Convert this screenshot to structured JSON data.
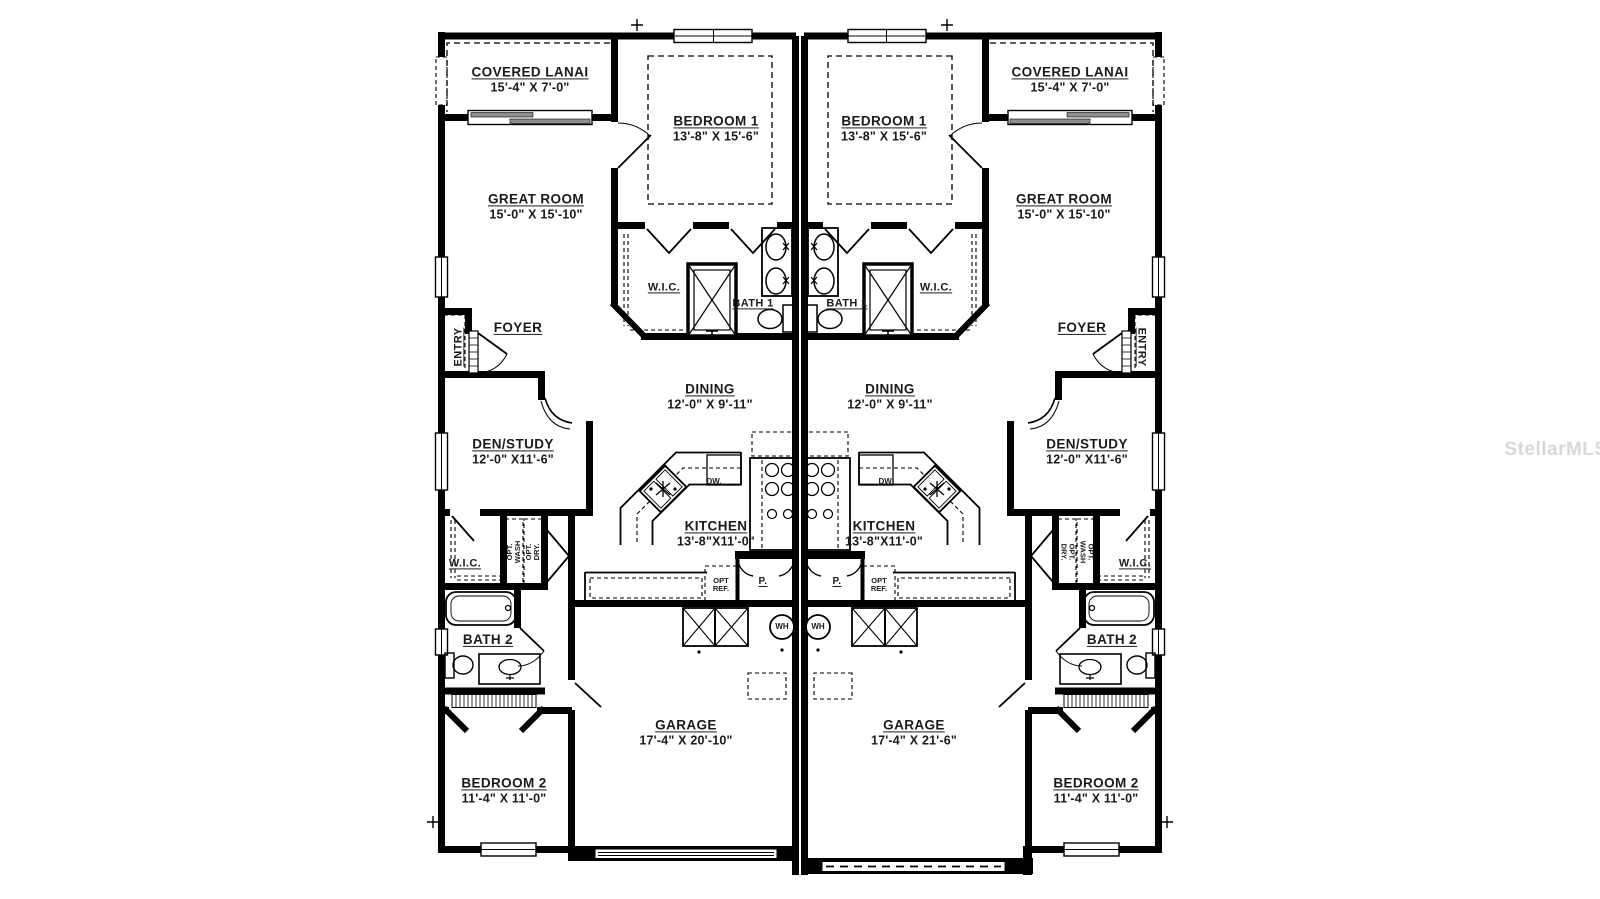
{
  "watermark": "StellarMLS",
  "colors": {
    "walls": "#000000",
    "background": "#ffffff",
    "watermark_text": "#d8d8d8",
    "sliding_door_panel": "#8f8f8f"
  },
  "rooms": {
    "covered_lanai": {
      "label": "COVERED LANAI",
      "dims": "15'-4\" X 7'-0\""
    },
    "great_room": {
      "label": "GREAT ROOM",
      "dims": "15'-0\" X 15'-10\""
    },
    "bedroom_1": {
      "label": "BEDROOM 1",
      "dims": "13'-8\" X 15'-6\""
    },
    "wic_primary": {
      "label": "W.I.C."
    },
    "bath_1": {
      "label": "BATH 1"
    },
    "dining": {
      "label": "DINING",
      "dims": "12'-0\" X 9'-11\""
    },
    "kitchen": {
      "label": "KITCHEN",
      "dims": "13'-8\"X11'-0\""
    },
    "entry": {
      "label": "ENTRY"
    },
    "foyer": {
      "label": "FOYER"
    },
    "den_study": {
      "label": "DEN/STUDY",
      "dims": "12'-0\" X11'-6\""
    },
    "wic_secondary": {
      "label": "W.I.C."
    },
    "bath_2": {
      "label": "BATH 2"
    },
    "bedroom_2": {
      "label": "BEDROOM 2",
      "dims": "11'-4\" X 11'-0\""
    },
    "garage_left": {
      "label": "GARAGE",
      "dims": "17'-4\" X 20'-10\""
    },
    "garage_right": {
      "label": "GARAGE",
      "dims": "17'-4\" X 21'-6\""
    },
    "pantry": {
      "label": "P."
    },
    "water_heater": {
      "label": "WH"
    },
    "dishwasher": {
      "label": "DW."
    },
    "opt_ref": {
      "line1": "OPT",
      "line2": "REF."
    },
    "opt_wash": {
      "line1": "OPT.",
      "line2": "WASH"
    },
    "opt_dry": {
      "line1": "OPT.",
      "line2": "DRY."
    }
  }
}
